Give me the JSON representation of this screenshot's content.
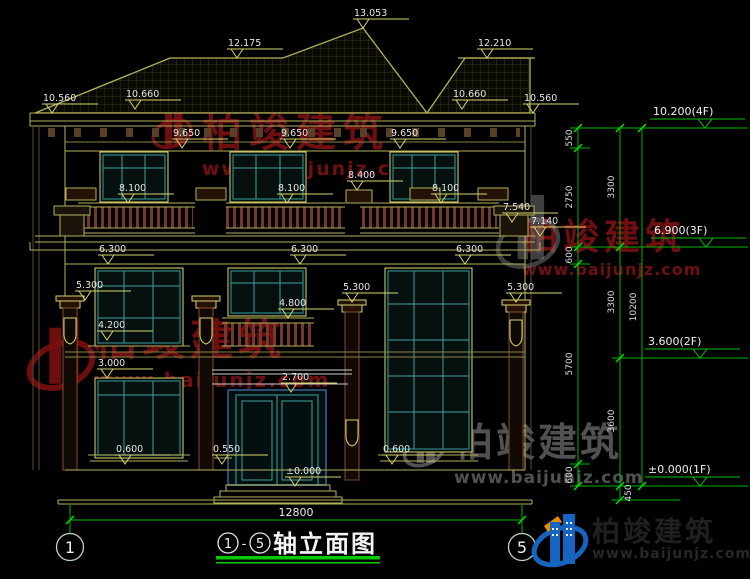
{
  "drawing": {
    "title": {
      "axis_from": "1",
      "separator": "-",
      "axis_to": "5",
      "name": "轴立面图"
    },
    "bottom_width_dim": "12800",
    "grid_bubbles": {
      "left": "1",
      "right": "5"
    },
    "elevation_marks": [
      {
        "v": "13.053"
      },
      {
        "v": "12.175"
      },
      {
        "v": "12.210"
      },
      {
        "v": "10.560"
      },
      {
        "v": "10.660"
      },
      {
        "v": "10.660"
      },
      {
        "v": "10.560"
      },
      {
        "v": "9.650"
      },
      {
        "v": "9.650"
      },
      {
        "v": "9.650"
      },
      {
        "v": "8.100"
      },
      {
        "v": "8.100"
      },
      {
        "v": "8.400"
      },
      {
        "v": "8.100"
      },
      {
        "v": "7.540"
      },
      {
        "v": "7.140"
      },
      {
        "v": "6.300"
      },
      {
        "v": "6.300"
      },
      {
        "v": "6.300"
      },
      {
        "v": "5.300"
      },
      {
        "v": "5.300"
      },
      {
        "v": "5.300"
      },
      {
        "v": "4.800"
      },
      {
        "v": "4.200"
      },
      {
        "v": "3.000"
      },
      {
        "v": "2.700"
      },
      {
        "v": "0.600"
      },
      {
        "v": "0.550"
      },
      {
        "v": "0.600"
      },
      {
        "v": "±0.000"
      }
    ],
    "floor_level_marks": [
      {
        "v": "10.200(4F)"
      },
      {
        "v": "6.900(3F)"
      },
      {
        "v": "3.600(2F)"
      },
      {
        "v": "±0.000(1F)"
      }
    ],
    "vertical_dims": [
      {
        "v": "550"
      },
      {
        "v": "2750"
      },
      {
        "v": "600"
      },
      {
        "v": "5700"
      },
      {
        "v": "600"
      },
      {
        "v": "3300"
      },
      {
        "v": "3300"
      },
      {
        "v": "3600"
      },
      {
        "v": "450"
      },
      {
        "v": "10200"
      }
    ]
  },
  "watermark": {
    "brand": "柏竣建筑",
    "url": "www.baijunjz.com"
  },
  "logo": {
    "brand": "柏竣建筑",
    "url": "www.baijunjz.com"
  },
  "colors": {
    "dimension_green": "#00c000",
    "marker_yellow": "#d9d36b",
    "line_olive": "#b5b05a",
    "window_teal": "#2e8585",
    "watermark_red": "#7a1010",
    "logo_blue": "#1565c0",
    "logo_orange": "#e68a00"
  }
}
